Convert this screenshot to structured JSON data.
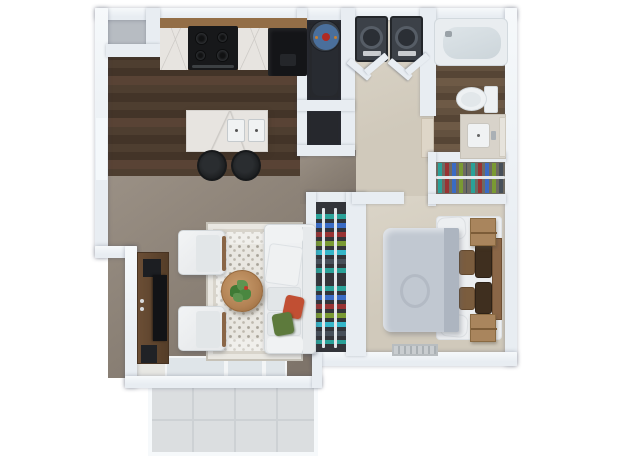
{
  "scene": {
    "type": "3d-rendered floor plan, top-down view",
    "unit": "one-bedroom apartment",
    "background": "#ffffff"
  },
  "rooms": [
    {
      "name": "Kitchen",
      "floor": "dark wood plank",
      "items": [
        "counter with marble top",
        "range with 4 burners",
        "black refrigerator",
        "kitchen island with double sink",
        "2 black bar stools",
        "corner pantry closet"
      ]
    },
    {
      "name": "Utility closet",
      "items": [
        "water heater",
        "lower storage niche"
      ]
    },
    {
      "name": "Laundry closet",
      "items": [
        "washer",
        "dryer",
        "2 bifold doors"
      ]
    },
    {
      "name": "Hallway",
      "floor": "light beige carpet",
      "items": []
    },
    {
      "name": "Bathroom",
      "floor": "dark wood plank",
      "items": [
        "bathtub",
        "toilet",
        "vanity with sink",
        "mirror",
        "open door panel"
      ]
    },
    {
      "name": "Bedroom closet",
      "items": [
        "hanging clothes",
        "shelf rail"
      ]
    },
    {
      "name": "Hall closet",
      "items": [
        "hanging clothes",
        "two vertical rails"
      ]
    },
    {
      "name": "Bedroom",
      "floor": "light beige carpet",
      "items": [
        "bed with gray duvet",
        "wood headboard",
        "white pillows",
        "tan pillows",
        "espresso pillows",
        "2 wood nightstands",
        "floor vent"
      ]
    },
    {
      "name": "Living room",
      "floor": "taupe carpet",
      "items": [
        "ornate area rug",
        "white sofa",
        "red pillow",
        "green pillow",
        "2 white armchairs",
        "round wood coffee table",
        "potted plant",
        "tv console",
        "tv",
        "speaker",
        "sliding glass door"
      ]
    },
    {
      "name": "Patio",
      "floor": "light gray tile",
      "items": []
    }
  ],
  "colors": {
    "wall": "#e8edf2",
    "wallHi": "#f6f9fb",
    "woodA": "#4e3e30",
    "woodB": "#433428",
    "woodC": "#594335",
    "bathA": "#63513f",
    "bathB": "#564535",
    "bathC": "#6e5a46",
    "carpetLiv": "#8c8277",
    "carpetLivLight": "#9a9085",
    "carpetLivDark": "#7c7268",
    "carpetBed": "#d0c9bb",
    "carpetBedLight": "#dbd5c8",
    "patio": "#dbdee0",
    "patioLine": "#cdd1d4",
    "counterWood": "#7c5b3c",
    "counterWoodHi": "#936e47",
    "marble": "#e7e4e0",
    "marbleVein": "#c9c6c2",
    "stove": "#17181a",
    "burner": "#2e3033",
    "burnerIn": "#111213",
    "handle": "#3c4043",
    "fridge": "#141518",
    "stool": "#2a2d30",
    "stoolIn": "#1b1d1f",
    "closetDark": "#33353a",
    "nicheDark": "#26282d",
    "laundryFloor": "#352d25",
    "pantryFloor": "#b7bcc2",
    "appliance": "#3c4148",
    "applianceEdge": "#23262a",
    "applianceDoor": "#565d66",
    "applianceIn": "#2b2f35",
    "ctrl": "#c9ccd0",
    "heaterBody": "#394049",
    "heaterCap": "#4a6f9c",
    "heaterDot": "#b02a23",
    "heaterSpot": "#c87f2f",
    "heaterShade": "#282b31",
    "rail": "#e3e7ea",
    "clTeal": "#2aa198",
    "clBlue": "#3a6bc4",
    "clMaroon": "#993333",
    "clOlive": "#7a9a33",
    "clChar": "#47505a",
    "clCyan": "#35b6c9",
    "tub": "#e9edf0",
    "tubEdge": "#d2d9de",
    "tubInner": "#ccd5da",
    "toilet": "#eef1f3",
    "toiletEdge": "#d4dade",
    "vanity": "#d8d3ca",
    "sink": "#f0f2f3",
    "mirror": "#e6e3dc",
    "doorPanel": "#ded6c8",
    "rugBase": "#e9e7e1",
    "rugBorder": "#c6c2b8",
    "rugBand": "#d8d4cb",
    "rugDot": "#a8a399",
    "rugDot2": "#bdb8ae",
    "sofa": "#e8eaec",
    "sofaEdge": "#d3d8db",
    "cushion": "#e2e6e8",
    "chairWood": "#8a6647",
    "pillowRed": "#c14f33",
    "pillowGreen": "#5d7a3c",
    "table": "#b28254",
    "tableEdge": "#96693d",
    "plantDark": "#3f7a35",
    "plantLight": "#5e9450",
    "berry": "#c0392b",
    "console": "#6b4e35",
    "consoleDark": "#543d28",
    "tv": "#121316",
    "component": "#1c1e22",
    "speaker": "#202226",
    "duvet": "#c1c8d1",
    "duvetFold": "#adb5c0",
    "mattress": "#eceef0",
    "mattressEdge": "#dde1e5",
    "headboard": "#8a6647",
    "headboardEdge": "#6e4f33",
    "pillowBrown": "#3f2f1f",
    "pillowTan": "#7b5d3e",
    "pillowWhite": "#edeff1",
    "nightstand": "#a9855d",
    "nightstandEdge": "#8a6a42",
    "drawerLine": "#7c5c38",
    "vent": "#c9cdd0",
    "ventLine": "#aab0b4",
    "glass": "#dfe5e9",
    "glassFrame": "#f3f5f6",
    "landing": "#e7e7e3",
    "window": "#f4f8fb"
  }
}
